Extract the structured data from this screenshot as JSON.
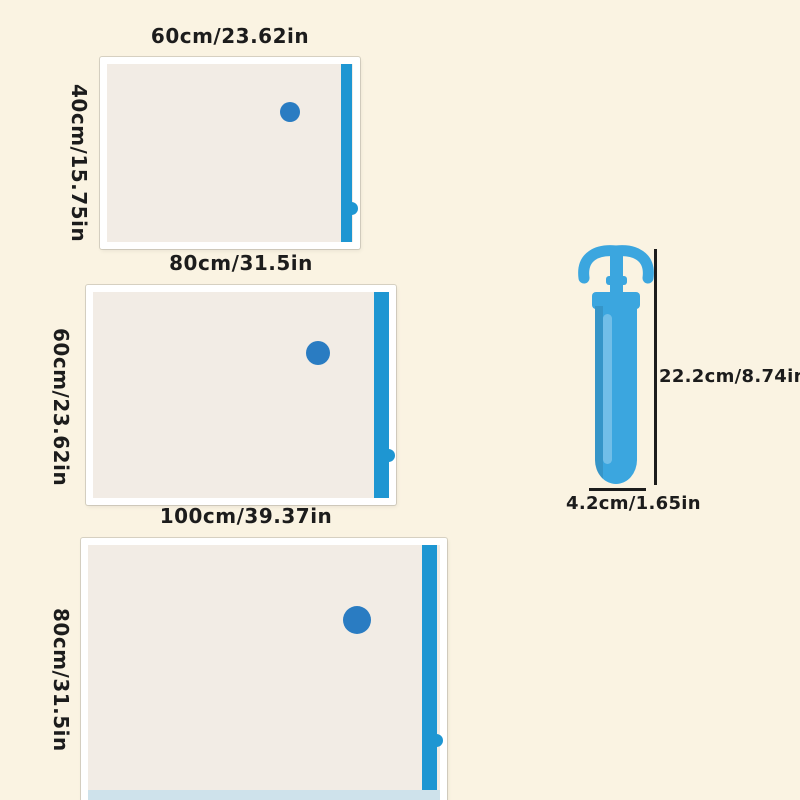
{
  "colors": {
    "bg": "#FAF3E2",
    "bag-fill": "#F2ECE5",
    "bag-border": "#FFFFFF",
    "strip": "#1E96D2",
    "valve": "#2A7CC2",
    "pump": "#3BA6DF",
    "pump-dark": "#1F86BE",
    "band": "#CEE2EB",
    "ink": "#1C1C1C"
  },
  "bags": [
    {
      "width_label": "60cm/23.62in",
      "height_label": "40cm/15.75in"
    },
    {
      "width_label": "80cm/31.5in",
      "height_label": "60cm/23.62in"
    },
    {
      "width_label": "100cm/39.37in",
      "height_label": "80cm/31.5in"
    }
  ],
  "pump": {
    "height_label": "22.2cm/8.74in",
    "width_label": "4.2cm/1.65in"
  }
}
